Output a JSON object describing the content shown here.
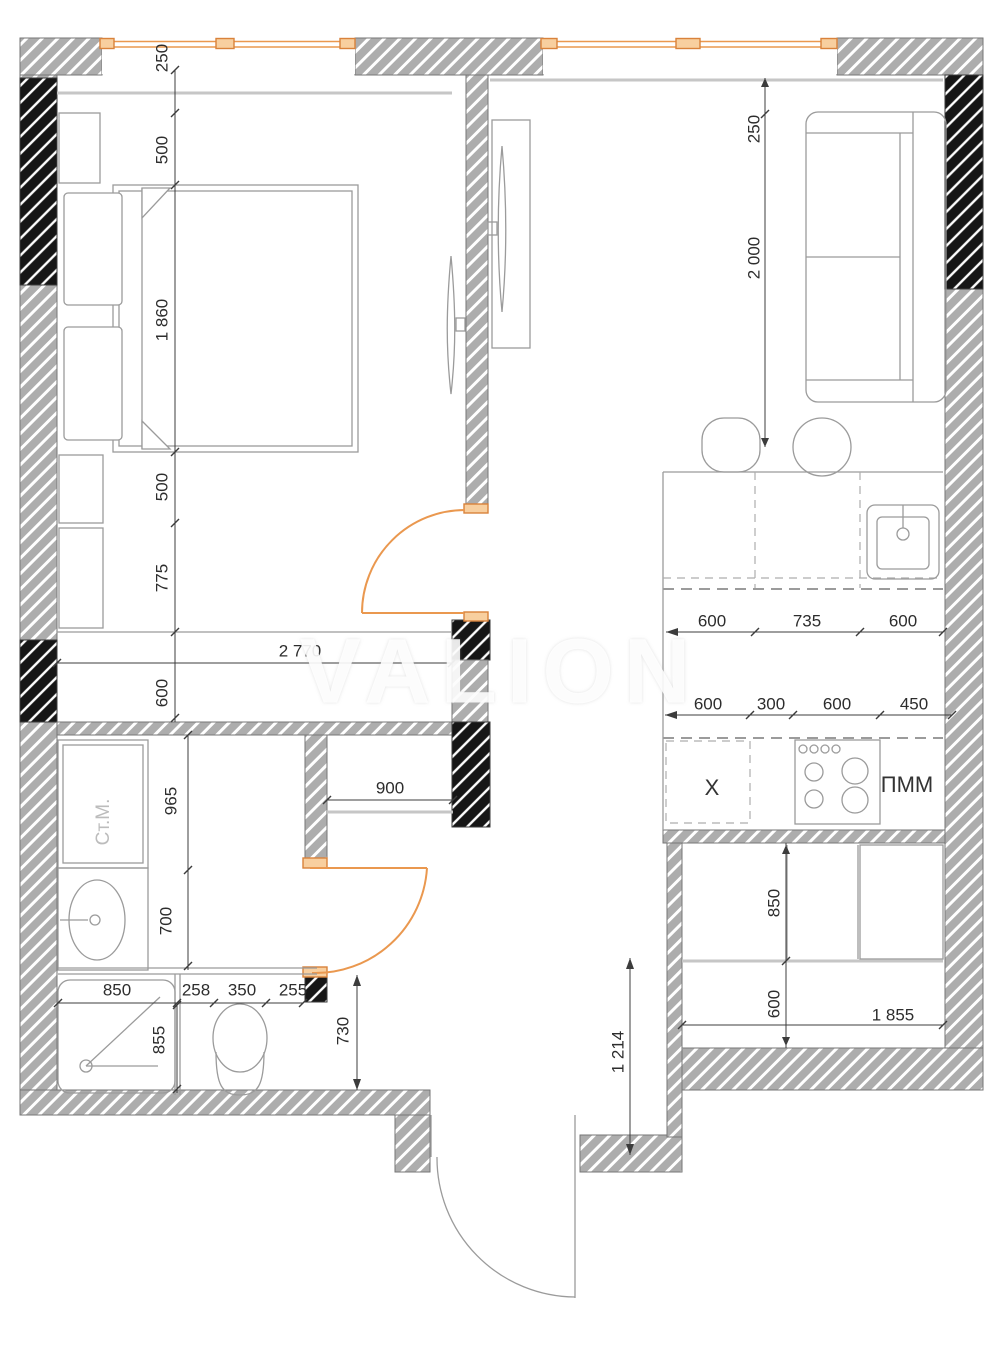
{
  "watermark": "VALION",
  "colors": {
    "accent_orange": "#ea984f",
    "wall_hatch_gray": "#adadad",
    "wall_hatch_black": "#161616",
    "furniture_line": "#9b9b9b",
    "dimension_text": "#2d2d2d"
  },
  "annotations": [
    {
      "label": "Ст.М.",
      "x": 104,
      "y": 822,
      "rot": 1,
      "style": "muted"
    },
    {
      "label": "X",
      "x": 712,
      "y": 789,
      "rot": 0,
      "style": "strong"
    },
    {
      "label": "ПММ",
      "x": 907,
      "y": 786,
      "rot": 0,
      "style": "strong"
    }
  ],
  "dimensions": [
    {
      "label": "250",
      "x": 163,
      "y": 58,
      "rot": 1
    },
    {
      "label": "500",
      "x": 163,
      "y": 150,
      "rot": 1
    },
    {
      "label": "1 860",
      "x": 163,
      "y": 320,
      "rot": 1
    },
    {
      "label": "500",
      "x": 163,
      "y": 487,
      "rot": 1
    },
    {
      "label": "775",
      "x": 163,
      "y": 578,
      "rot": 1
    },
    {
      "label": "600",
      "x": 163,
      "y": 693,
      "rot": 1
    },
    {
      "label": "2 770",
      "x": 300,
      "y": 652,
      "rot": 0
    },
    {
      "label": "250",
      "x": 755,
      "y": 129,
      "rot": 1
    },
    {
      "label": "2 000",
      "x": 755,
      "y": 258,
      "rot": 1
    },
    {
      "label": "600",
      "x": 712,
      "y": 622,
      "rot": 0
    },
    {
      "label": "735",
      "x": 807,
      "y": 622,
      "rot": 0
    },
    {
      "label": "600",
      "x": 903,
      "y": 622,
      "rot": 0
    },
    {
      "label": "600",
      "x": 708,
      "y": 705,
      "rot": 0
    },
    {
      "label": "300",
      "x": 771,
      "y": 705,
      "rot": 0
    },
    {
      "label": "600",
      "x": 837,
      "y": 705,
      "rot": 0
    },
    {
      "label": "450",
      "x": 914,
      "y": 705,
      "rot": 0
    },
    {
      "label": "850",
      "x": 775,
      "y": 903,
      "rot": 1
    },
    {
      "label": "600",
      "x": 775,
      "y": 1004,
      "rot": 1
    },
    {
      "label": "1 855",
      "x": 893,
      "y": 1016,
      "rot": 0
    },
    {
      "label": "965",
      "x": 172,
      "y": 801,
      "rot": 1
    },
    {
      "label": "700",
      "x": 167,
      "y": 921,
      "rot": 1
    },
    {
      "label": "900",
      "x": 390,
      "y": 789,
      "rot": 0
    },
    {
      "label": "850",
      "x": 117,
      "y": 991,
      "rot": 0
    },
    {
      "label": "258",
      "x": 196,
      "y": 991,
      "rot": 0
    },
    {
      "label": "350",
      "x": 242,
      "y": 991,
      "rot": 0
    },
    {
      "label": "255",
      "x": 293,
      "y": 991,
      "rot": 0
    },
    {
      "label": "855",
      "x": 160,
      "y": 1040,
      "rot": 1
    },
    {
      "label": "730",
      "x": 344,
      "y": 1031,
      "rot": 1
    },
    {
      "label": "1 214",
      "x": 619,
      "y": 1052,
      "rot": 1
    }
  ]
}
